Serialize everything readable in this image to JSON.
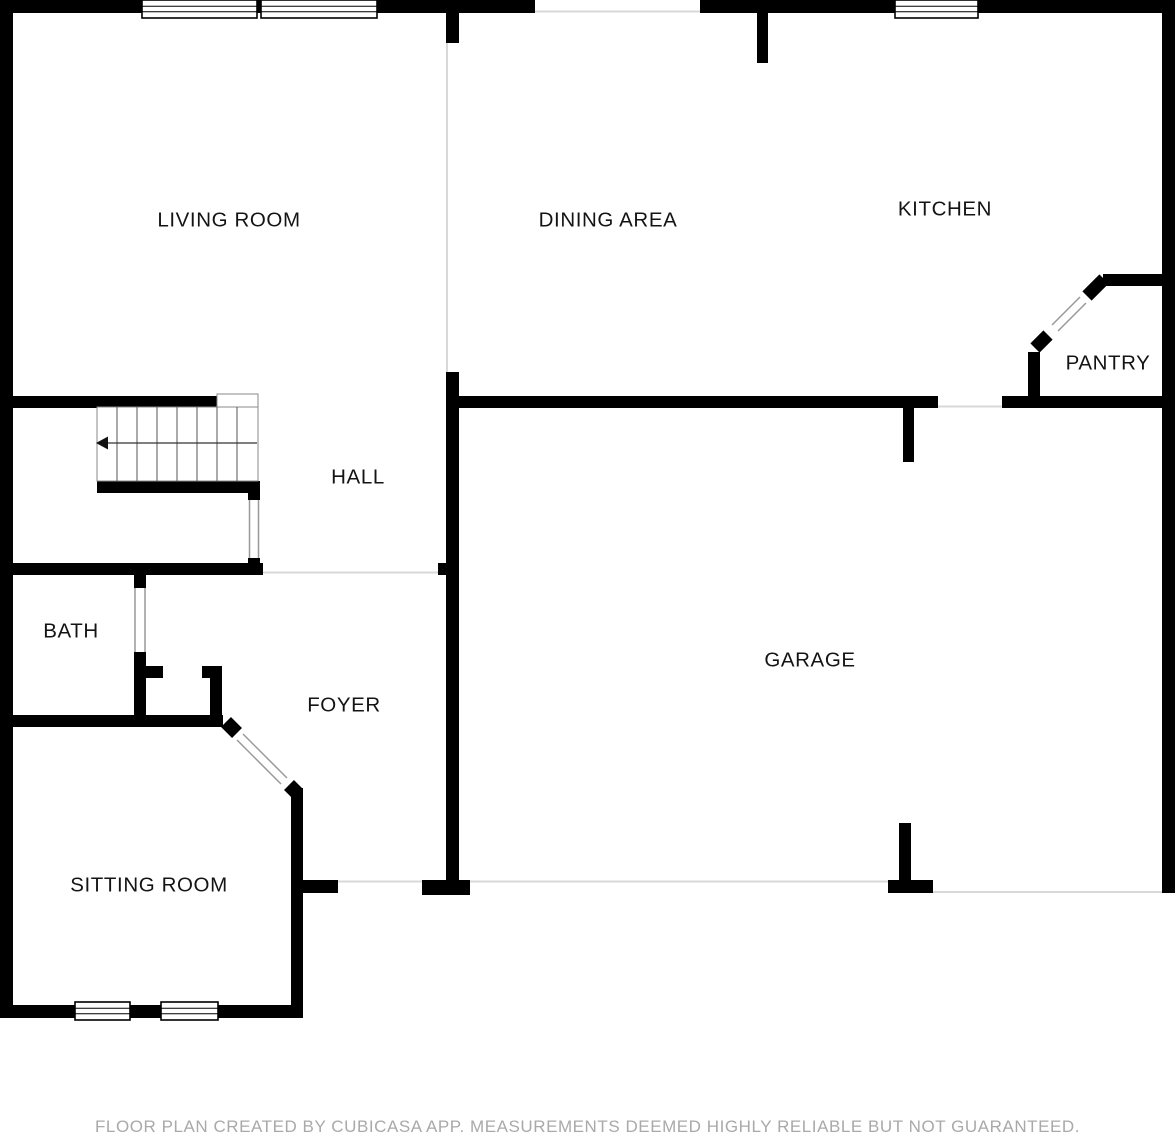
{
  "plan": {
    "width": 1175,
    "height": 1134,
    "creator": "CubiCasa"
  },
  "rooms": {
    "living_room": {
      "label": "LIVING ROOM"
    },
    "dining_area": {
      "label": "DINING AREA"
    },
    "kitchen": {
      "label": "KITCHEN"
    },
    "pantry": {
      "label": "PANTRY"
    },
    "hall": {
      "label": "HALL"
    },
    "bath": {
      "label": "BATH"
    },
    "foyer": {
      "label": "FOYER"
    },
    "sitting_room": {
      "label": "SITTING ROOM"
    },
    "garage": {
      "label": "GARAGE"
    }
  },
  "footer": {
    "disclaimer": "FLOOR PLAN CREATED BY CUBICASA APP. MEASUREMENTS DEEMED HIGHLY RELIABLE BUT NOT GUARANTEED."
  },
  "colors": {
    "wall": "#000000",
    "room_divider_line": "#d8d8d8",
    "door_opening_line": "#999999",
    "label_text": "#141414",
    "footer_text": "#a9a9a9",
    "background": "#ffffff"
  }
}
